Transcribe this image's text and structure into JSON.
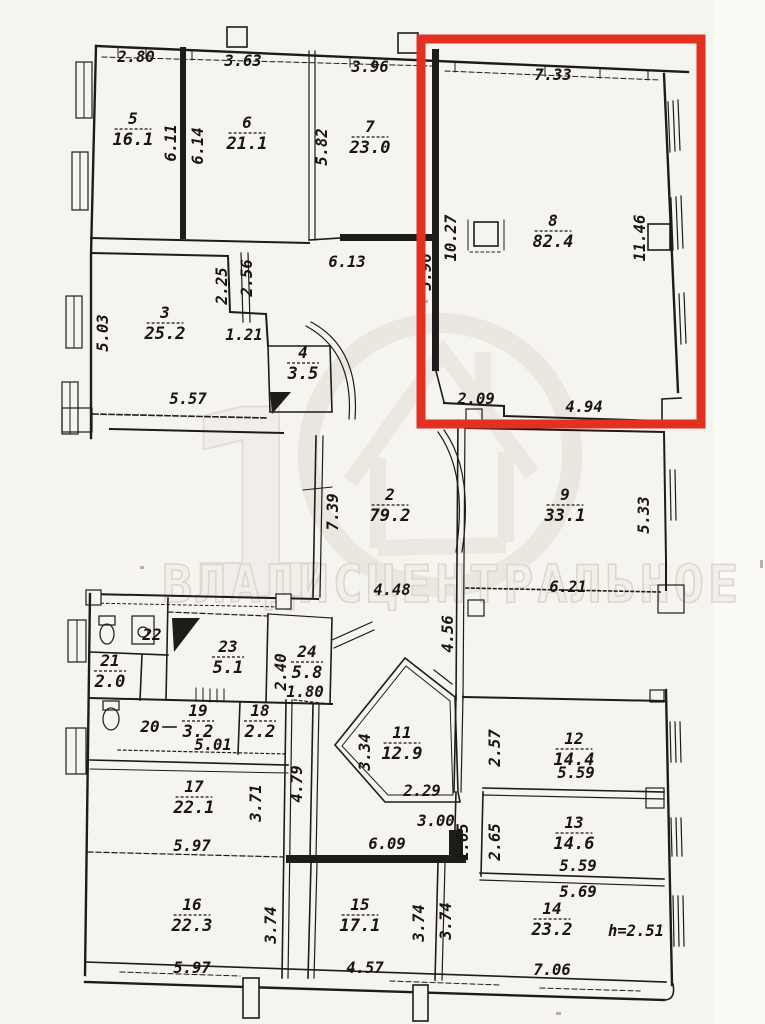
{
  "document": {
    "kind": "scanned apartment floor plan (BTI plan) with red highlight annotation",
    "height_note": "h=2.51"
  },
  "highlight": {
    "color": "#e23122",
    "highlighted_room": "8"
  },
  "watermark": {
    "brand_text": "ВЛАДИСЦЕНТРАЛЬНОЕ",
    "big_digit": "1",
    "color": "#cfc9c1"
  },
  "rooms": [
    {
      "n": "5",
      "a": "16.1",
      "x": 133,
      "y": 124
    },
    {
      "n": "6",
      "a": "21.1",
      "x": 247,
      "y": 128
    },
    {
      "n": "7",
      "a": "23.0",
      "x": 370,
      "y": 132
    },
    {
      "n": "8",
      "a": "82.4",
      "x": 553,
      "y": 226
    },
    {
      "n": "3",
      "a": "25.2",
      "x": 165,
      "y": 318
    },
    {
      "n": "4",
      "a": "3.5",
      "x": 303,
      "y": 358
    },
    {
      "n": "2",
      "a": "79.2",
      "x": 390,
      "y": 500
    },
    {
      "n": "9",
      "a": "33.1",
      "x": 565,
      "y": 500
    },
    {
      "n": "22",
      "a": "",
      "x": 152,
      "y": 640
    },
    {
      "n": "21",
      "a": "2.0",
      "x": 110,
      "y": 666
    },
    {
      "n": "23",
      "a": "5.1",
      "x": 228,
      "y": 652
    },
    {
      "n": "24",
      "a": "5.8",
      "x": 307,
      "y": 657
    },
    {
      "n": "20",
      "a": "",
      "x": 150,
      "y": 732
    },
    {
      "n": "19",
      "a": "3.2",
      "x": 198,
      "y": 716
    },
    {
      "n": "18",
      "a": "2.2",
      "x": 260,
      "y": 716
    },
    {
      "n": "11",
      "a": "12.9",
      "x": 402,
      "y": 738
    },
    {
      "n": "12",
      "a": "14.4",
      "x": 574,
      "y": 744
    },
    {
      "n": "13",
      "a": "14.6",
      "x": 574,
      "y": 828
    },
    {
      "n": "14",
      "a": "23.2",
      "x": 552,
      "y": 914
    },
    {
      "n": "17",
      "a": "22.1",
      "x": 194,
      "y": 792
    },
    {
      "n": "16",
      "a": "22.3",
      "x": 192,
      "y": 910
    },
    {
      "n": "15",
      "a": "17.1",
      "x": 360,
      "y": 910
    }
  ],
  "dimensions": [
    {
      "v": "2.80",
      "x": 136,
      "y": 62,
      "r": 0
    },
    {
      "v": "3.63",
      "x": 243,
      "y": 66,
      "r": 0
    },
    {
      "v": "3.96",
      "x": 370,
      "y": 72,
      "r": 0
    },
    {
      "v": "7.33",
      "x": 553,
      "y": 80,
      "r": 0
    },
    {
      "v": "6.11",
      "x": 176,
      "y": 143,
      "r": 1
    },
    {
      "v": "6.14",
      "x": 203,
      "y": 146,
      "r": 1
    },
    {
      "v": "5.82",
      "x": 327,
      "y": 147,
      "r": 1
    },
    {
      "v": "10.27",
      "x": 456,
      "y": 238,
      "r": 1
    },
    {
      "v": "11.46",
      "x": 645,
      "y": 238,
      "r": 1
    },
    {
      "v": "5.96",
      "x": 431,
      "y": 272,
      "r": 1
    },
    {
      "v": "2.25",
      "x": 227,
      "y": 286,
      "r": 1
    },
    {
      "v": "2.56",
      "x": 252,
      "y": 278,
      "r": 1
    },
    {
      "v": "6.13",
      "x": 347,
      "y": 267,
      "r": 0
    },
    {
      "v": "1.21",
      "x": 244,
      "y": 340,
      "r": 0
    },
    {
      "v": "5.03",
      "x": 108,
      "y": 333,
      "r": 1
    },
    {
      "v": "5.57",
      "x": 188,
      "y": 404,
      "r": 0
    },
    {
      "v": "2.09",
      "x": 476,
      "y": 404,
      "r": 0
    },
    {
      "v": "4.94",
      "x": 584,
      "y": 412,
      "r": 0
    },
    {
      "v": "7.39",
      "x": 338,
      "y": 512,
      "r": 1
    },
    {
      "v": "4.48",
      "x": 392,
      "y": 595,
      "r": 0
    },
    {
      "v": "5.33",
      "x": 649,
      "y": 515,
      "r": 1
    },
    {
      "v": "6.21",
      "x": 568,
      "y": 592,
      "r": 0
    },
    {
      "v": "4.56",
      "x": 453,
      "y": 634,
      "r": 1
    },
    {
      "v": "2.40",
      "x": 286,
      "y": 672,
      "r": 1
    },
    {
      "v": "1.80",
      "x": 305,
      "y": 697,
      "r": 0
    },
    {
      "v": "5.01",
      "x": 213,
      "y": 750,
      "r": 0
    },
    {
      "v": "2.57",
      "x": 500,
      "y": 748,
      "r": 1
    },
    {
      "v": "3.34",
      "x": 370,
      "y": 752,
      "r": 1
    },
    {
      "v": "2.29",
      "x": 422,
      "y": 796,
      "r": 0
    },
    {
      "v": "3.00",
      "x": 436,
      "y": 826,
      "r": 0
    },
    {
      "v": "6.09",
      "x": 387,
      "y": 849,
      "r": 0
    },
    {
      "v": "1.65",
      "x": 468,
      "y": 842,
      "r": 1
    },
    {
      "v": "2.65",
      "x": 500,
      "y": 842,
      "r": 1
    },
    {
      "v": "5.59",
      "x": 576,
      "y": 778,
      "r": 0
    },
    {
      "v": "5.59",
      "x": 578,
      "y": 871,
      "r": 0
    },
    {
      "v": "5.69",
      "x": 578,
      "y": 897,
      "r": 0
    },
    {
      "v": "4.79",
      "x": 302,
      "y": 784,
      "r": 1
    },
    {
      "v": "3.71",
      "x": 261,
      "y": 803,
      "r": 1
    },
    {
      "v": "5.97",
      "x": 192,
      "y": 851,
      "r": 0
    },
    {
      "v": "3.74",
      "x": 276,
      "y": 925,
      "r": 1
    },
    {
      "v": "3.74",
      "x": 424,
      "y": 923,
      "r": 1
    },
    {
      "v": "3.74",
      "x": 451,
      "y": 921,
      "r": 1
    },
    {
      "v": "5.97",
      "x": 192,
      "y": 973,
      "r": 0
    },
    {
      "v": "4.57",
      "x": 365,
      "y": 973,
      "r": 0
    },
    {
      "v": "7.06",
      "x": 552,
      "y": 975,
      "r": 0
    },
    {
      "v": "h=2.51",
      "x": 636,
      "y": 936,
      "r": 0
    }
  ]
}
